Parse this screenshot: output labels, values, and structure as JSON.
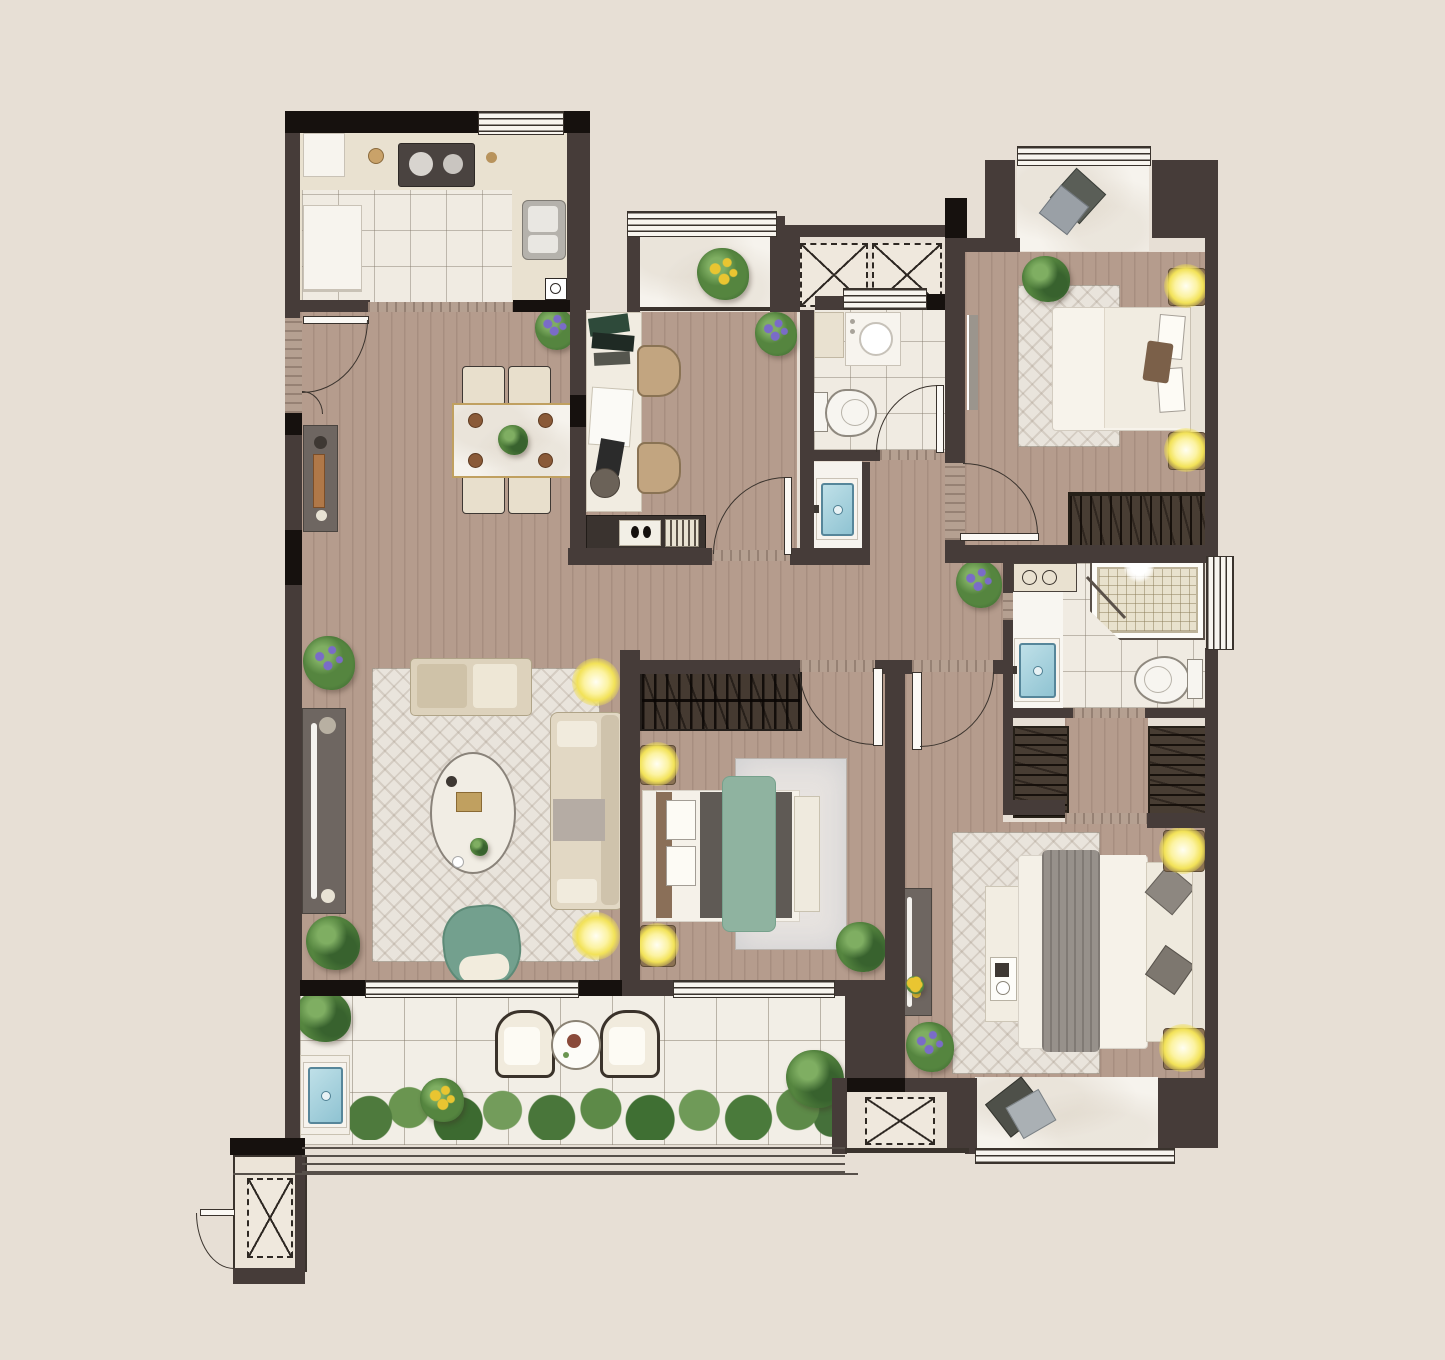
{
  "title": "apartment-floor-plan",
  "palette": {
    "background": "#e7dfd5",
    "wall": "#463c39",
    "wall_accent_black": "#16110e",
    "wood_floor": "#b59c8d",
    "tile_floor": "#f0ebe2",
    "counter_beige": "#e9e1d0",
    "stone_threshold": "#b5a091",
    "rug_cream": "#e9e4dc",
    "furniture_white": "#f6f2ea",
    "sofa_beige": "#ddd2bc",
    "bed_platform_gray": "#5f5a55",
    "blanket_gray": "#97918b",
    "blanket_green": "#8fb3a0",
    "chair_teal": "#73a08e",
    "lamp_glow_yellow": "#f2e35a",
    "lamp_base_brown": "#8a7152",
    "wardrobe_dark": "#483d33",
    "sink_water_blue": "#a7d3de",
    "plant_green": "#55853f",
    "flower_purple": "#7a6cc8",
    "flower_yellow": "#e9c531",
    "outline_dark": "#3a332d",
    "table_gold_trim": "#c0a060"
  },
  "legend": {
    "regions": [
      "kitchen",
      "dining-area",
      "entry",
      "study",
      "north-balcony",
      "utility-shafts",
      "bathroom",
      "hall-corridor",
      "bedroom-north",
      "walk-in-closet",
      "master-bathroom",
      "master-bedroom",
      "middle-bedroom",
      "living-room",
      "south-balcony",
      "bay-windows"
    ],
    "fixtures": [
      "fridge",
      "cooktop",
      "kitchen-sink",
      "dining-table",
      "dining-chairs",
      "sideboard",
      "desk",
      "desk-chairs",
      "washing-machine",
      "toilet",
      "wash-basin",
      "shower",
      "bed",
      "nightstand-lamp",
      "wardrobe",
      "bookshelf",
      "sofa",
      "coffee-table",
      "accent-chair",
      "tv-console",
      "outdoor-armchairs",
      "outdoor-table",
      "planting",
      "railing"
    ]
  }
}
